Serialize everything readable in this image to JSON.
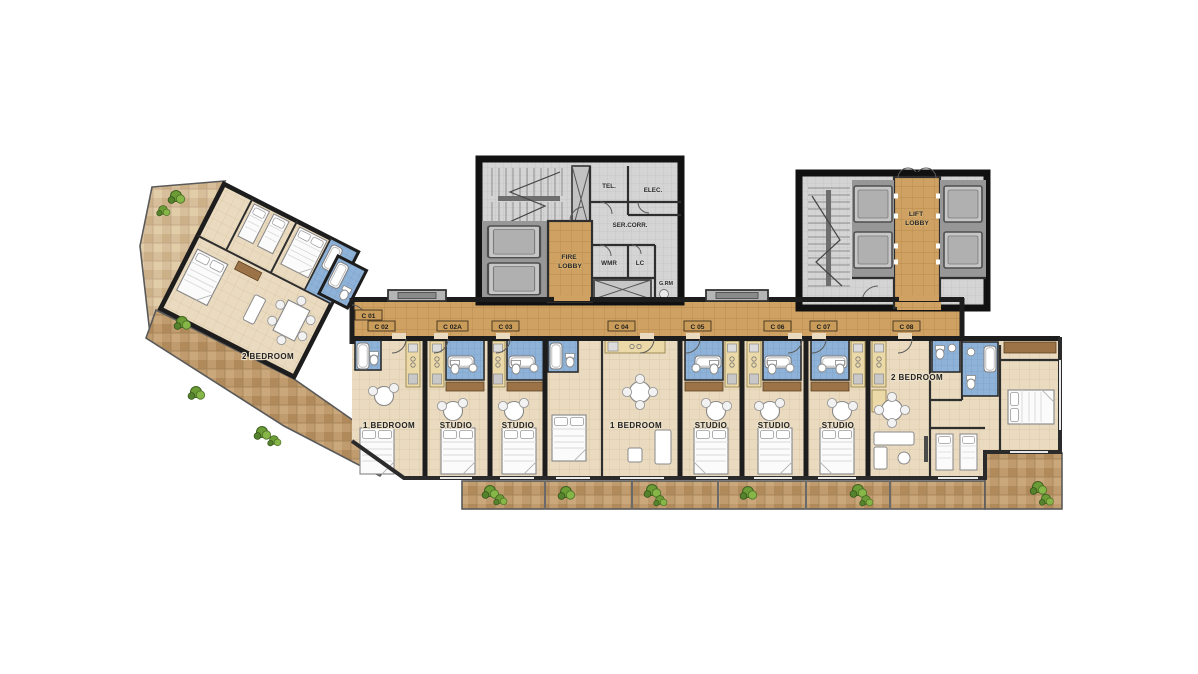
{
  "plan": {
    "badges": [
      {
        "id": "c01",
        "label": "C 01"
      },
      {
        "id": "c02",
        "label": "C 02"
      },
      {
        "id": "c02a",
        "label": "C 02A"
      },
      {
        "id": "c03",
        "label": "C 03"
      },
      {
        "id": "c04",
        "label": "C 04"
      },
      {
        "id": "c05",
        "label": "C 05"
      },
      {
        "id": "c06",
        "label": "C 06"
      },
      {
        "id": "c07",
        "label": "C 07"
      },
      {
        "id": "c08",
        "label": "C 08"
      }
    ],
    "rooms": [
      {
        "unit": "c01",
        "label": "2 BEDROOM"
      },
      {
        "unit": "c02",
        "label": "1 BEDROOM"
      },
      {
        "unit": "c02a",
        "label": "STUDIO"
      },
      {
        "unit": "c03",
        "label": "STUDIO"
      },
      {
        "unit": "c04",
        "label": "1 BEDROOM"
      },
      {
        "unit": "c05",
        "label": "STUDIO"
      },
      {
        "unit": "c06",
        "label": "STUDIO"
      },
      {
        "unit": "c07",
        "label": "STUDIO"
      },
      {
        "unit": "c08",
        "label": "2 BEDROOM"
      }
    ],
    "core_left": {
      "fire_lobby": [
        "FIRE",
        "LOBBY"
      ],
      "ser_corr": "SER.CORR.",
      "tel": "TEL.",
      "elec": "ELEC.",
      "wmr": "WMR",
      "lc": "LC",
      "grm": "G.RM"
    },
    "core_right": {
      "lift_lobby": [
        "LIFT",
        "LOBBY"
      ]
    },
    "colors": {
      "corridor": "#cfa263",
      "unit_floor": "#eadbc0",
      "terrace": "#bf9a6d",
      "terrace_light": "#d8bf9c",
      "bathroom": "#8fb3d8",
      "wall": "#1d1d1d",
      "core_floor": "#d2d2d2",
      "plant": "#5d8f2f"
    }
  }
}
